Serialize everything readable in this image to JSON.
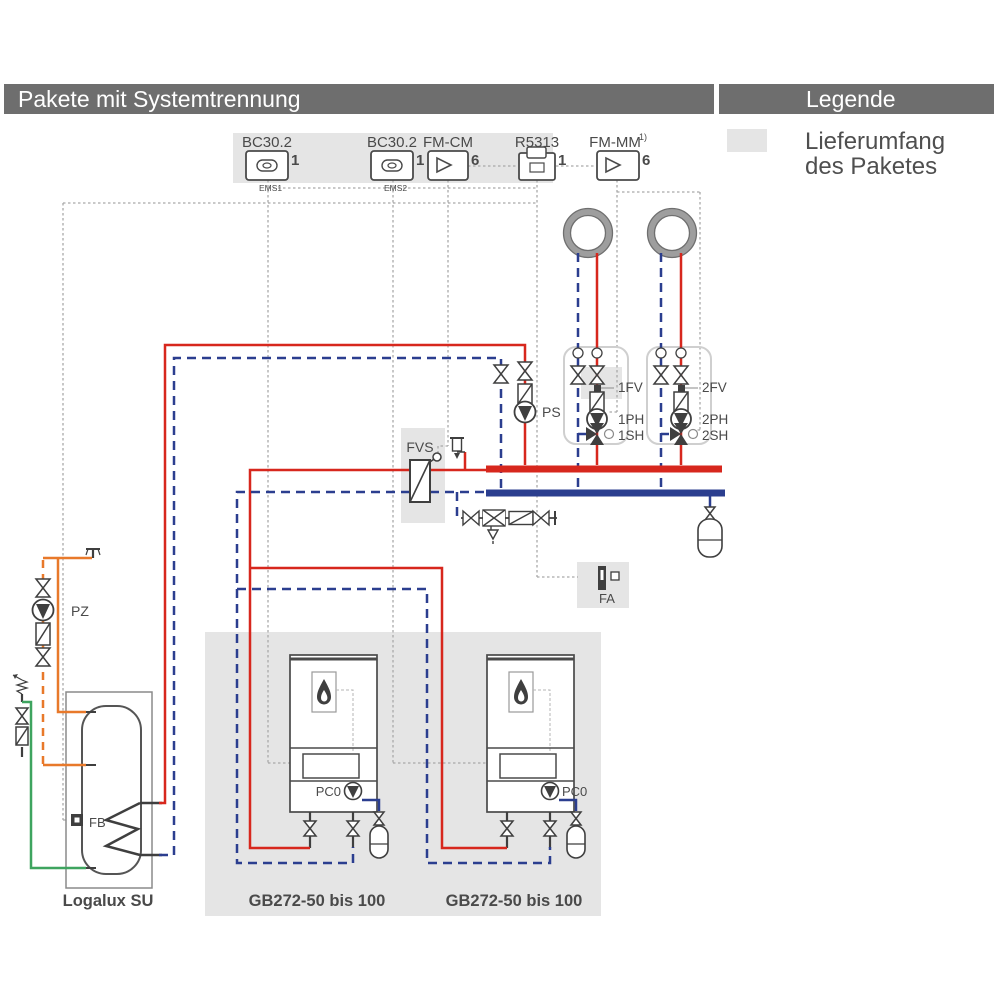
{
  "header": {
    "title": "Pakete mit Systemtrennung",
    "legend_title": "Legende"
  },
  "legend": {
    "line1": "Lieferumfang",
    "line2": "des Paketes"
  },
  "modules": {
    "bc1": {
      "name": "BC30.2",
      "qty": "1",
      "bus": "EMS1"
    },
    "bc2": {
      "name": "BC30.2",
      "qty": "1",
      "bus": "EMS2"
    },
    "fmcm": {
      "name": "FM-CM",
      "qty": "6"
    },
    "r5313": {
      "name": "R5313",
      "qty": "1"
    },
    "fmmm": {
      "name": "FM-MM",
      "footnote": "1)",
      "qty": "6"
    }
  },
  "labels": {
    "ps": "PS",
    "pz": "PZ",
    "fvs": "FVS",
    "fa": "FA",
    "fb": "FB"
  },
  "circuits": {
    "c1": {
      "fv": "1FV",
      "ph": "1PH",
      "sh": "1SH"
    },
    "c2": {
      "fv": "2FV",
      "ph": "2PH",
      "sh": "2SH"
    }
  },
  "boilers": {
    "pump1": "PC0",
    "pump2": "PC0",
    "label1": "GB272-50 bis 100",
    "label2": "GB272-50 bis 100"
  },
  "tank": {
    "label": "Logalux SU"
  },
  "colors": {
    "flow_red": "#d7271d",
    "return_blue": "#2b3e8f",
    "dhw_orange": "#e8792a",
    "cold_green": "#3ea45f",
    "highlight_gray": "#e5e5e5",
    "bar_gray": "#6e6e6e"
  }
}
